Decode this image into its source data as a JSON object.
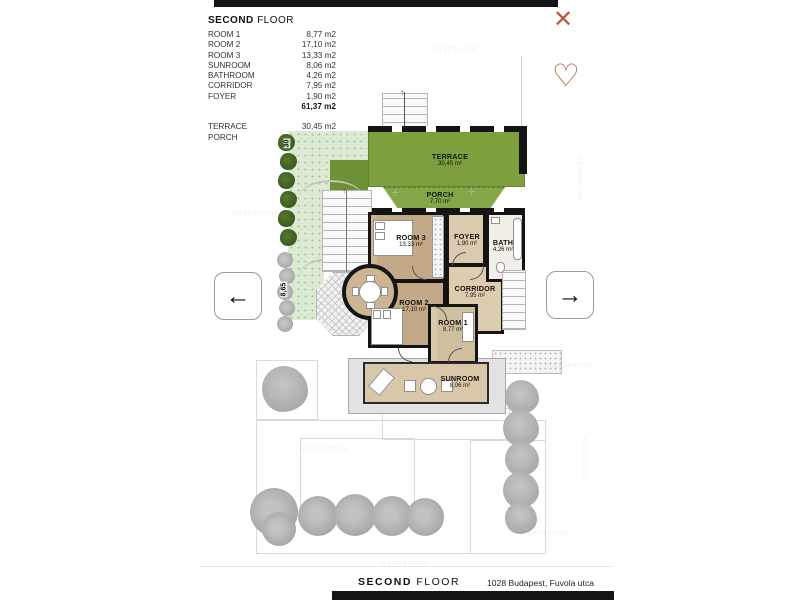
{
  "header": {
    "close_icon": "✕",
    "heart_icon": "♡"
  },
  "legend": {
    "title_bold": "SECOND",
    "title_rest": " FLOOR",
    "rows": [
      {
        "label": "ROOM 1",
        "value": "8,77 m2"
      },
      {
        "label": "ROOM 2",
        "value": "17,10 m2"
      },
      {
        "label": "ROOM 3",
        "value": "13,33 m2"
      },
      {
        "label": "SUNROOM",
        "value": "8,06 m2"
      },
      {
        "label": "BATHROOM",
        "value": "4,26 m2"
      },
      {
        "label": "CORRIDOR",
        "value": "7,95 m2"
      },
      {
        "label": "FOYER",
        "value": "1,90 m2"
      }
    ],
    "total": {
      "label": "",
      "value": "61,37 m2"
    },
    "outdoor_rows": [
      {
        "label": "TERRACE",
        "value": "30,45 m2"
      },
      {
        "label": "PORCH",
        "value": "7,70 m2"
      }
    ]
  },
  "nav": {
    "prev_icon": "←",
    "next_icon": "→"
  },
  "plan": {
    "terrace": {
      "name": "TERRACE",
      "area": "30,45 m²"
    },
    "porch": {
      "name": "PORCH",
      "area": "7,70 m²"
    },
    "room3": {
      "name": "ROOM 3",
      "area": "13,33 m²"
    },
    "foyer": {
      "name": "FOYER",
      "area": "1,90 m²"
    },
    "bath": {
      "name": "BATH",
      "area": "4,26 m²"
    },
    "corridor": {
      "name": "CORRIDOR",
      "area": "7,95 m²"
    },
    "room2": {
      "name": "ROOM 2",
      "area": "17,10 m²"
    },
    "room1": {
      "name": "ROOM 1",
      "area": "8,77 m²"
    },
    "sunroom": {
      "name": "SUNROOM",
      "area": "8,06 m²"
    },
    "dimensions": {
      "left_upper": "30",
      "left_lower": "8,65"
    },
    "stairs_arrow": "↑"
  },
  "footer": {
    "title_bold": "SECOND",
    "title_rest": " FLOOR",
    "address": "1028 Budapest, Fuvola utca"
  },
  "watermark": "ingatlancom"
}
